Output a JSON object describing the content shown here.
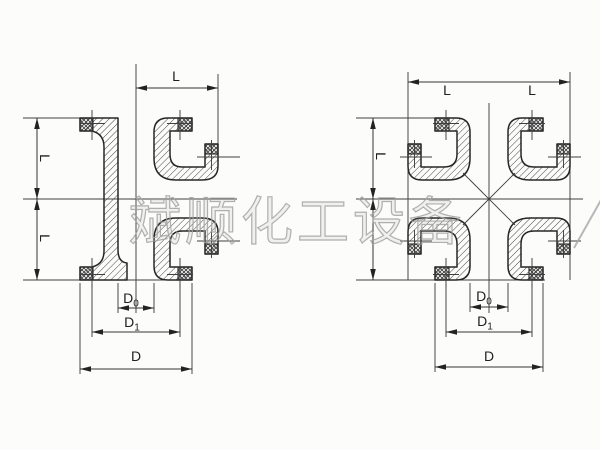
{
  "watermark": {
    "text": "斌顺化工设备",
    "color": "#a2a2a2"
  },
  "drawing": {
    "labels": {
      "length": "L",
      "diameter": "D",
      "sub_bore": "0",
      "sub_bolt": "1"
    },
    "views": [
      {
        "name": "left-section-view",
        "dimensions": [
          "L",
          "L",
          "L",
          "D0",
          "D1",
          "D"
        ]
      },
      {
        "name": "right-section-view",
        "dimensions": [
          "L",
          "L",
          "L",
          "D0",
          "D1",
          "D"
        ]
      }
    ],
    "colors": {
      "line": "#2a2a2a",
      "paper": "#fcfcfb",
      "watermark": "#a2a2a2"
    }
  }
}
